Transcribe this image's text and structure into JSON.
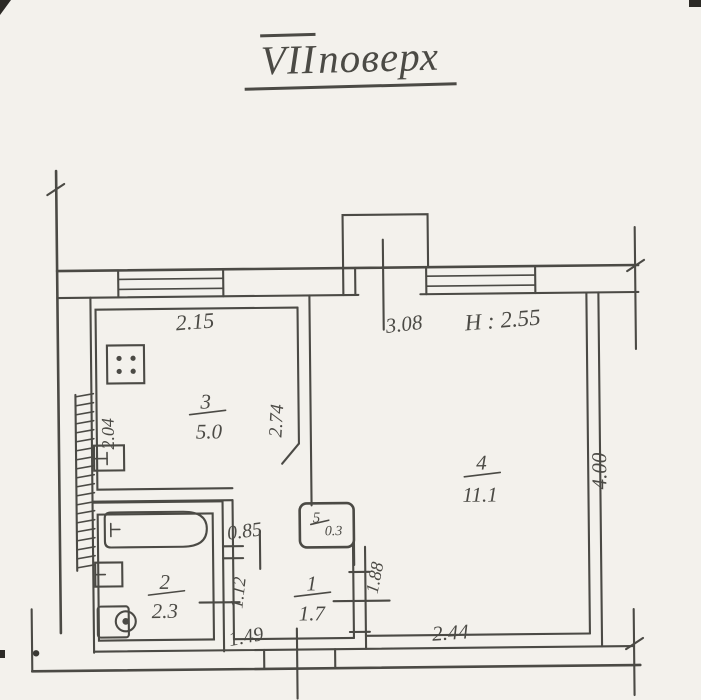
{
  "page": {
    "title_roman": "VII",
    "title_word": "поверх"
  },
  "plan": {
    "ceiling_height": "H : 2.55",
    "rooms": {
      "hallway": {
        "number": "1",
        "area": "1.7"
      },
      "bathroom": {
        "number": "2",
        "area": "2.3"
      },
      "kitchen": {
        "number": "3",
        "area": "5.0"
      },
      "living": {
        "number": "4",
        "area": "11.1"
      },
      "closet": {
        "number": "5",
        "area": "0.3"
      }
    },
    "dimensions": {
      "kitchen_top_width": "2.15",
      "living_window_offset": "3.08",
      "kitchen_left_depth": "2.04",
      "kitchen_living_wall": "2.74",
      "living_depth": "4.00",
      "living_bottom_width": "2.44",
      "living_hall_wall": "1.88",
      "kitchen_passage_width": "0.85",
      "hall_bath_wall": "1.12",
      "hall_bottom_width": "1.49"
    },
    "colors": {
      "ink": "#4b4a45",
      "paper": "#f3f1ec"
    }
  }
}
